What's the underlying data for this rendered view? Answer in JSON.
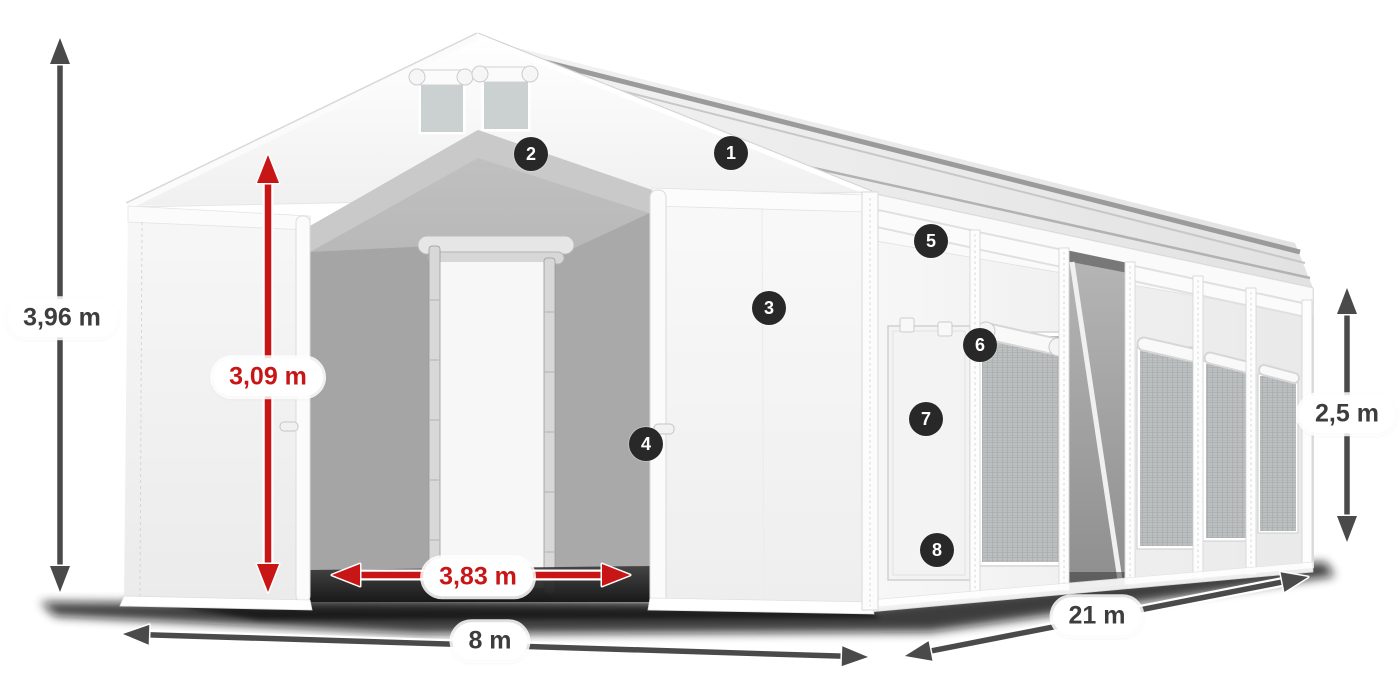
{
  "diagram": {
    "dimension_labels": {
      "total_height": "3,96 m",
      "clearance_height": "3,09 m",
      "passage_width": "3,83 m",
      "front_width": "8 m",
      "side_length": "21 m",
      "wall_height": "2,5 m"
    },
    "callouts": [
      {
        "number": "1"
      },
      {
        "number": "2"
      },
      {
        "number": "3"
      },
      {
        "number": "4"
      },
      {
        "number": "5"
      },
      {
        "number": "6"
      },
      {
        "number": "7"
      },
      {
        "number": "8"
      }
    ],
    "colors": {
      "dimension_red": "#c81515",
      "dimension_gray": "#4a4a4a",
      "label_text_dark": "#3d3d3d",
      "callout_background": "#282828",
      "callout_text": "#ffffff"
    }
  }
}
